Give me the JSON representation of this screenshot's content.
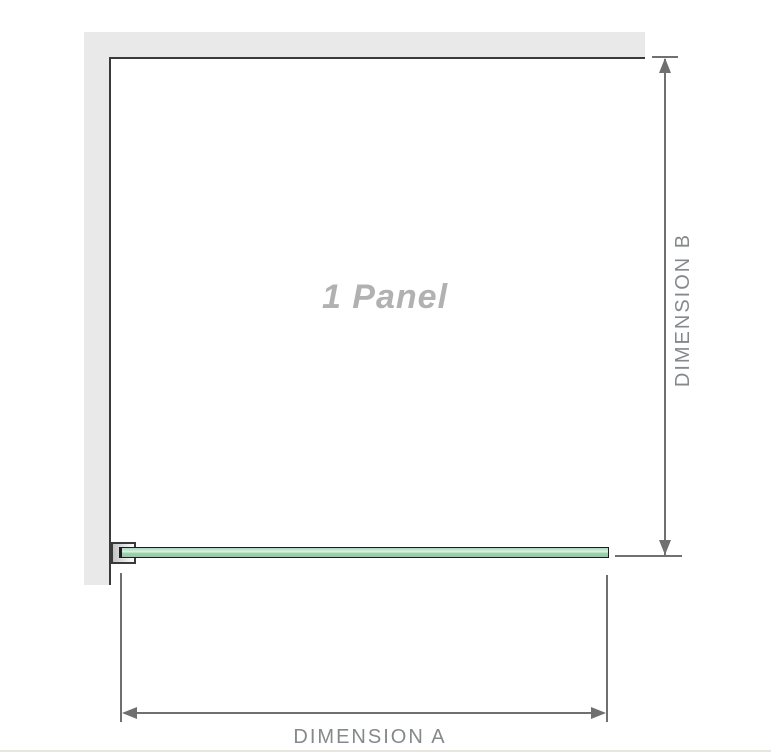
{
  "diagram": {
    "title": "1 Panel",
    "type": "shower-screen-plan-view",
    "dimensions": {
      "horizontal": {
        "label": "DIMENSION A"
      },
      "vertical": {
        "label": "DIMENSION B"
      }
    },
    "parts": {
      "wall": "wall (L-shaped, top and left)",
      "bracket": "wall-mount bracket",
      "glass": "glass panel"
    },
    "colors": {
      "background": "#ffffff",
      "wall": "#e9e9e9",
      "outline": "#3a3a3a",
      "glass_green": "#9dd3af",
      "glass_highlight": "#ddf0e3",
      "glass_border": "#1e1e1e",
      "bracket_fill": "#c4c4c4",
      "dimension_line": "#707070",
      "label_text": "#85898b",
      "title_text": "#b1b1b1",
      "bottom_separator": "#e8e6df"
    }
  }
}
